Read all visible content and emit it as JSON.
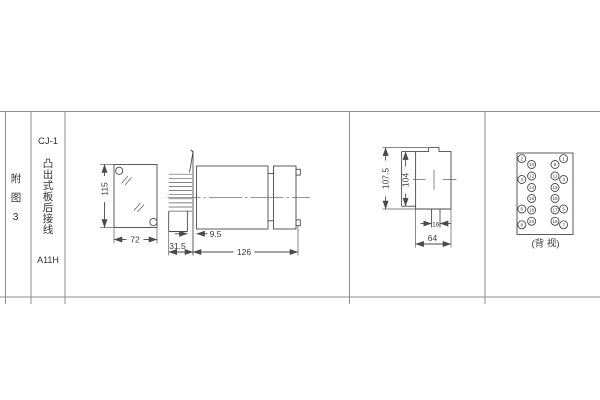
{
  "sidebar": {
    "figure_label": "附图3",
    "model": "CJ-1",
    "mount_type": "凸出式板后接线",
    "code": "A11H"
  },
  "front_view": {
    "height": "115",
    "width": "72"
  },
  "side_view": {
    "terminal_depth": "31.5",
    "panel_gap": "9.5",
    "body_length": "126"
  },
  "profile_view": {
    "outer_height": "107.5",
    "inner_height": "104",
    "notch_width": "16",
    "width": "64"
  },
  "back_view": {
    "caption": "(背 视)",
    "outer_left": [
      "2",
      "4",
      "6",
      "8"
    ],
    "outer_right": [
      "1",
      "3",
      "5",
      "7"
    ],
    "inner_left": [
      "10",
      "12",
      "14",
      "16",
      "18",
      "20"
    ],
    "inner_right": [
      "9",
      "11",
      "13",
      "15",
      "17",
      "19"
    ]
  },
  "colors": {
    "line": "#4a4a4a",
    "table_border": "#8e8e8e",
    "text": "#333333"
  }
}
